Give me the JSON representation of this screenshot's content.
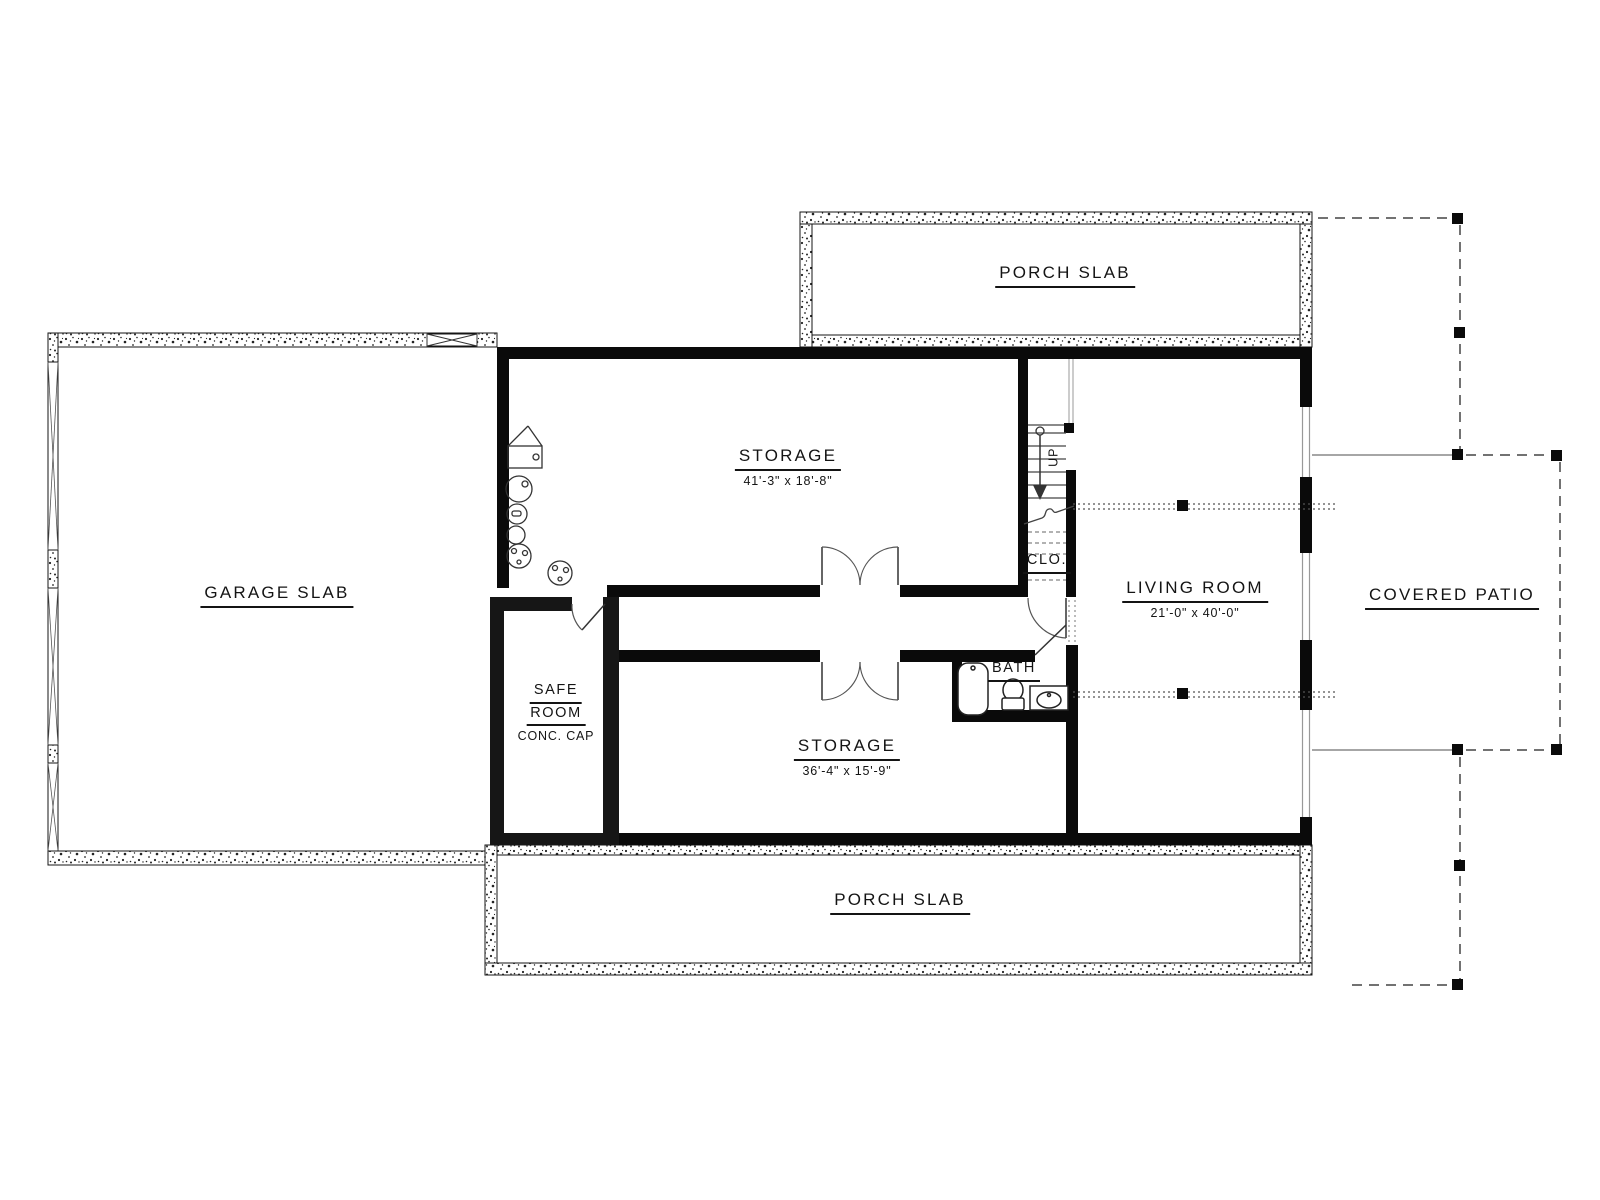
{
  "title": "Basement / Slab Floor Plan",
  "colors": {
    "line": "#141414",
    "wall": "#0a0a0a",
    "safe_room_wall": "#161616",
    "beam_dotted": "#555555",
    "patio_thin_line": "#888888",
    "background": "#ffffff"
  },
  "areas": {
    "porch_top": {
      "label": "PORCH SLAB"
    },
    "porch_bottom": {
      "label": "PORCH SLAB"
    },
    "garage": {
      "label": "GARAGE SLAB"
    },
    "storage_upper": {
      "label": "STORAGE",
      "dims": "41'-3\" x 18'-8\""
    },
    "storage_lower": {
      "label": "STORAGE",
      "dims": "36'-4\" x 15'-9\""
    },
    "living_room": {
      "label": "LIVING ROOM",
      "dims": "21'-0\" x 40'-0\""
    },
    "covered_patio": {
      "label": "COVERED PATIO"
    },
    "safe_room": {
      "line1": "SAFE",
      "line2": "ROOM",
      "note": "CONC. CAP"
    },
    "bath": {
      "label": "BATH"
    },
    "closet": {
      "label": "CLO."
    },
    "stairs": {
      "label": "UP"
    }
  }
}
